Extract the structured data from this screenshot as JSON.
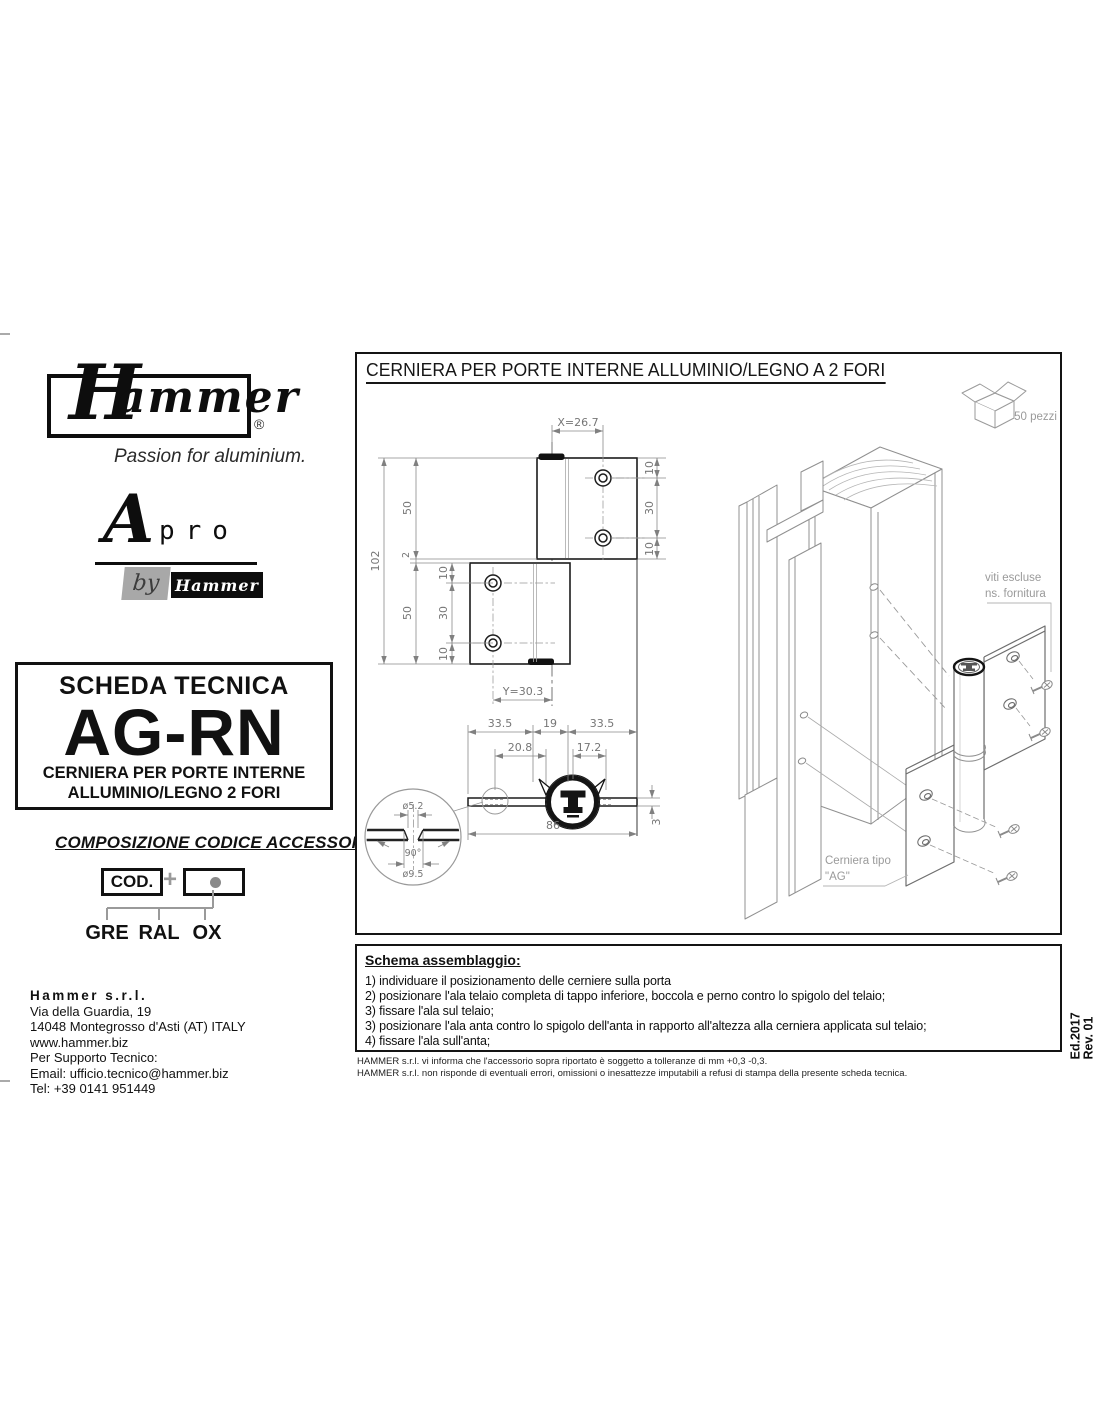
{
  "branding": {
    "logo_text": "Hammer",
    "logo_initial": "H",
    "logo_rest": "ammer",
    "registered_mark": "®",
    "tagline": "Passion for aluminium.",
    "apro_a": "A",
    "apro_pro": "pro",
    "apro_by": "by",
    "apro_by_brand": "Hammer"
  },
  "tech_sheet": {
    "header": "SCHEDA TECNICA",
    "code": "AG-RN",
    "subtitle_line1": "CERNIERA PER PORTE INTERNE",
    "subtitle_line2": "ALLUMINIO/LEGNO 2 FORI"
  },
  "accessories_code": {
    "title": "COMPOSIZIONE CODICE ACCESSORI",
    "cod_label": "COD.",
    "plus": "+",
    "options": [
      "GRE",
      "RAL",
      "OX"
    ]
  },
  "company": {
    "name": "Hammer s.r.l.",
    "address_line1": "Via della Guardia, 19",
    "address_line2": "14048 Montegrosso d'Asti (AT) ITALY",
    "website": "www.hammer.biz",
    "support_label": "Per Supporto Tecnico:",
    "email": "Email: ufficio.tecnico@hammer.biz",
    "phone": "Tel: +39 0141 951449"
  },
  "drawing": {
    "title": "CERNIERA PER PORTE INTERNE ALLUMINIO/LEGNO A 2 FORI",
    "package_qty": "50 pezzi",
    "front_view": {
      "x_dim": "X=26.7",
      "y_dim": "Y=30.3",
      "total_height": "102",
      "leaf_height": "50",
      "gap": "2",
      "edge_to_hole": "10",
      "hole_spacing": "30"
    },
    "top_view": {
      "leaf_width": "33.5",
      "knuckle_width": "19",
      "hole_offset_left": "20.8",
      "hole_offset_right": "17.2",
      "total_width": "86",
      "thickness": "3"
    },
    "detail_view": {
      "hole_diameter": "ø5.2",
      "countersink_angle": "90°",
      "countersink_diameter": "ø9.5"
    },
    "notes": {
      "screws_line1": "viti escluse",
      "screws_line2": "ns. fornitura",
      "hinge_type_line1": "Cerniera tipo",
      "hinge_type_line2": "\"AG\""
    }
  },
  "assembly": {
    "title": "Schema assemblaggio:",
    "steps": [
      "1) individuare il posizionamento delle cerniere sulla porta",
      "2) posizionare l'ala telaio completa di tappo inferiore, boccola e perno contro lo spigolo del telaio;",
      "3) fissare l'ala sul telaio;",
      "3) posizionare l'ala anta contro lo spigolo dell'anta in rapporto all'altezza alla cerniera applicata sul telaio;",
      "4) fissare l'ala sull'anta;"
    ]
  },
  "disclaimer": {
    "line1": "HAMMER s.r.l. vi informa che l'accessorio sopra riportato è soggetto a tolleranze di mm +0,3 -0,3.",
    "line2": "HAMMER s.r.l. non risponde di eventuali errori, omissioni o inesattezze imputabili a refusi di stampa della presente scheda tecnica."
  },
  "edition": {
    "edition": "Ed.2017",
    "revision": "Rev. 01"
  }
}
